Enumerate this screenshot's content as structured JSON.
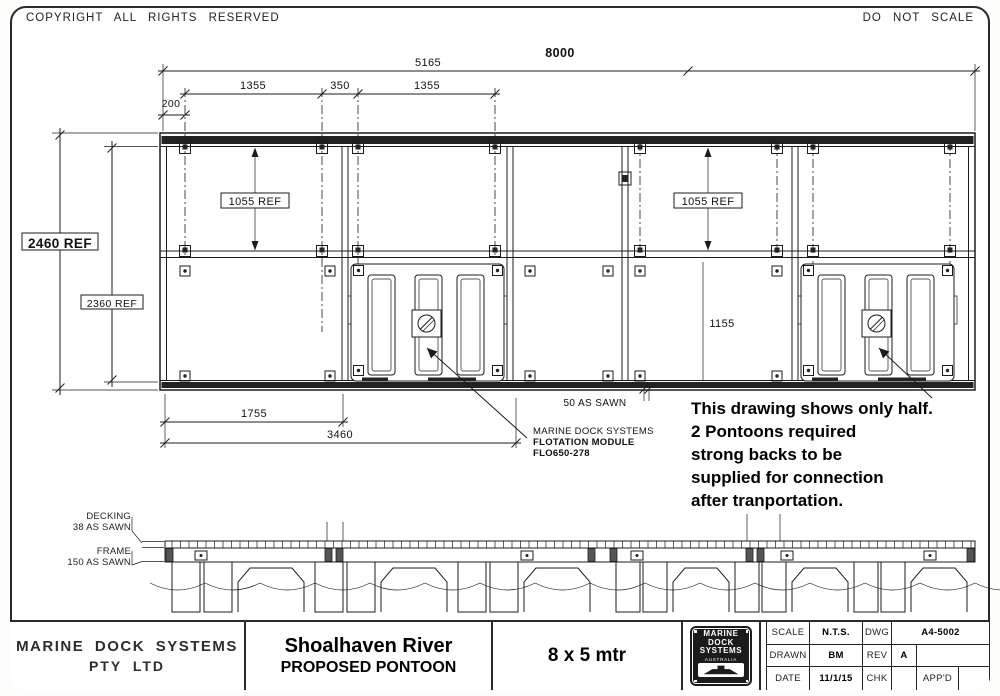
{
  "header": {
    "copyright": "COPYRIGHT  ALL  RIGHTS  RESERVED",
    "do_not_scale": "DO  NOT  SCALE"
  },
  "plan": {
    "dims": {
      "overall": "8000",
      "half": "5165",
      "mod_a": "1355",
      "mod_gap": "350",
      "mod_b": "1355",
      "edge": "200",
      "cell_left": "1055 REF",
      "cell_right": "1055 REF",
      "depth_outer": "2460 REF",
      "depth_inner": "2360 REF",
      "cell_bottom": "1155",
      "bottom_a": "1755",
      "bottom_b": "3460",
      "sawn": "50 AS SAWN"
    },
    "module_label": {
      "line1": "MARINE DOCK SYSTEMS",
      "line2": "FLOTATION MODULE",
      "line3": "FLO650-278"
    },
    "note_lines": [
      "This drawing shows only half.",
      "2 Pontoons required",
      "strong backs to be",
      "supplied for connection",
      "after tranportation."
    ]
  },
  "elevation": {
    "decking_label": "DECKING",
    "decking_dim": "38 AS SAWN",
    "frame_label": "FRAME",
    "frame_dim": "150 AS SAWN"
  },
  "title_block": {
    "company_line1": "MARINE  DOCK  SYSTEMS",
    "company_line2": "PTY  LTD",
    "project": "Shoalhaven River",
    "drawing_title": "PROPOSED PONTOON",
    "size": "8 x 5 mtr",
    "logo": {
      "line1": "MARINE",
      "line2": "DOCK",
      "line3": "SYSTEMS",
      "line4": "AUSTRALIA"
    },
    "fields": {
      "scale_label": "SCALE",
      "scale_value": "N.T.S.",
      "drawn_label": "DRAWN",
      "drawn_value": "BM",
      "date_label": "DATE",
      "date_value": "11/1/15",
      "dwg_label": "DWG",
      "dwg_value": "A4-5002",
      "rev_label": "REV",
      "rev_value": "A",
      "chk_label": "CHK",
      "chk_value": "",
      "appd_label": "APP'D",
      "appd_value": ""
    }
  }
}
